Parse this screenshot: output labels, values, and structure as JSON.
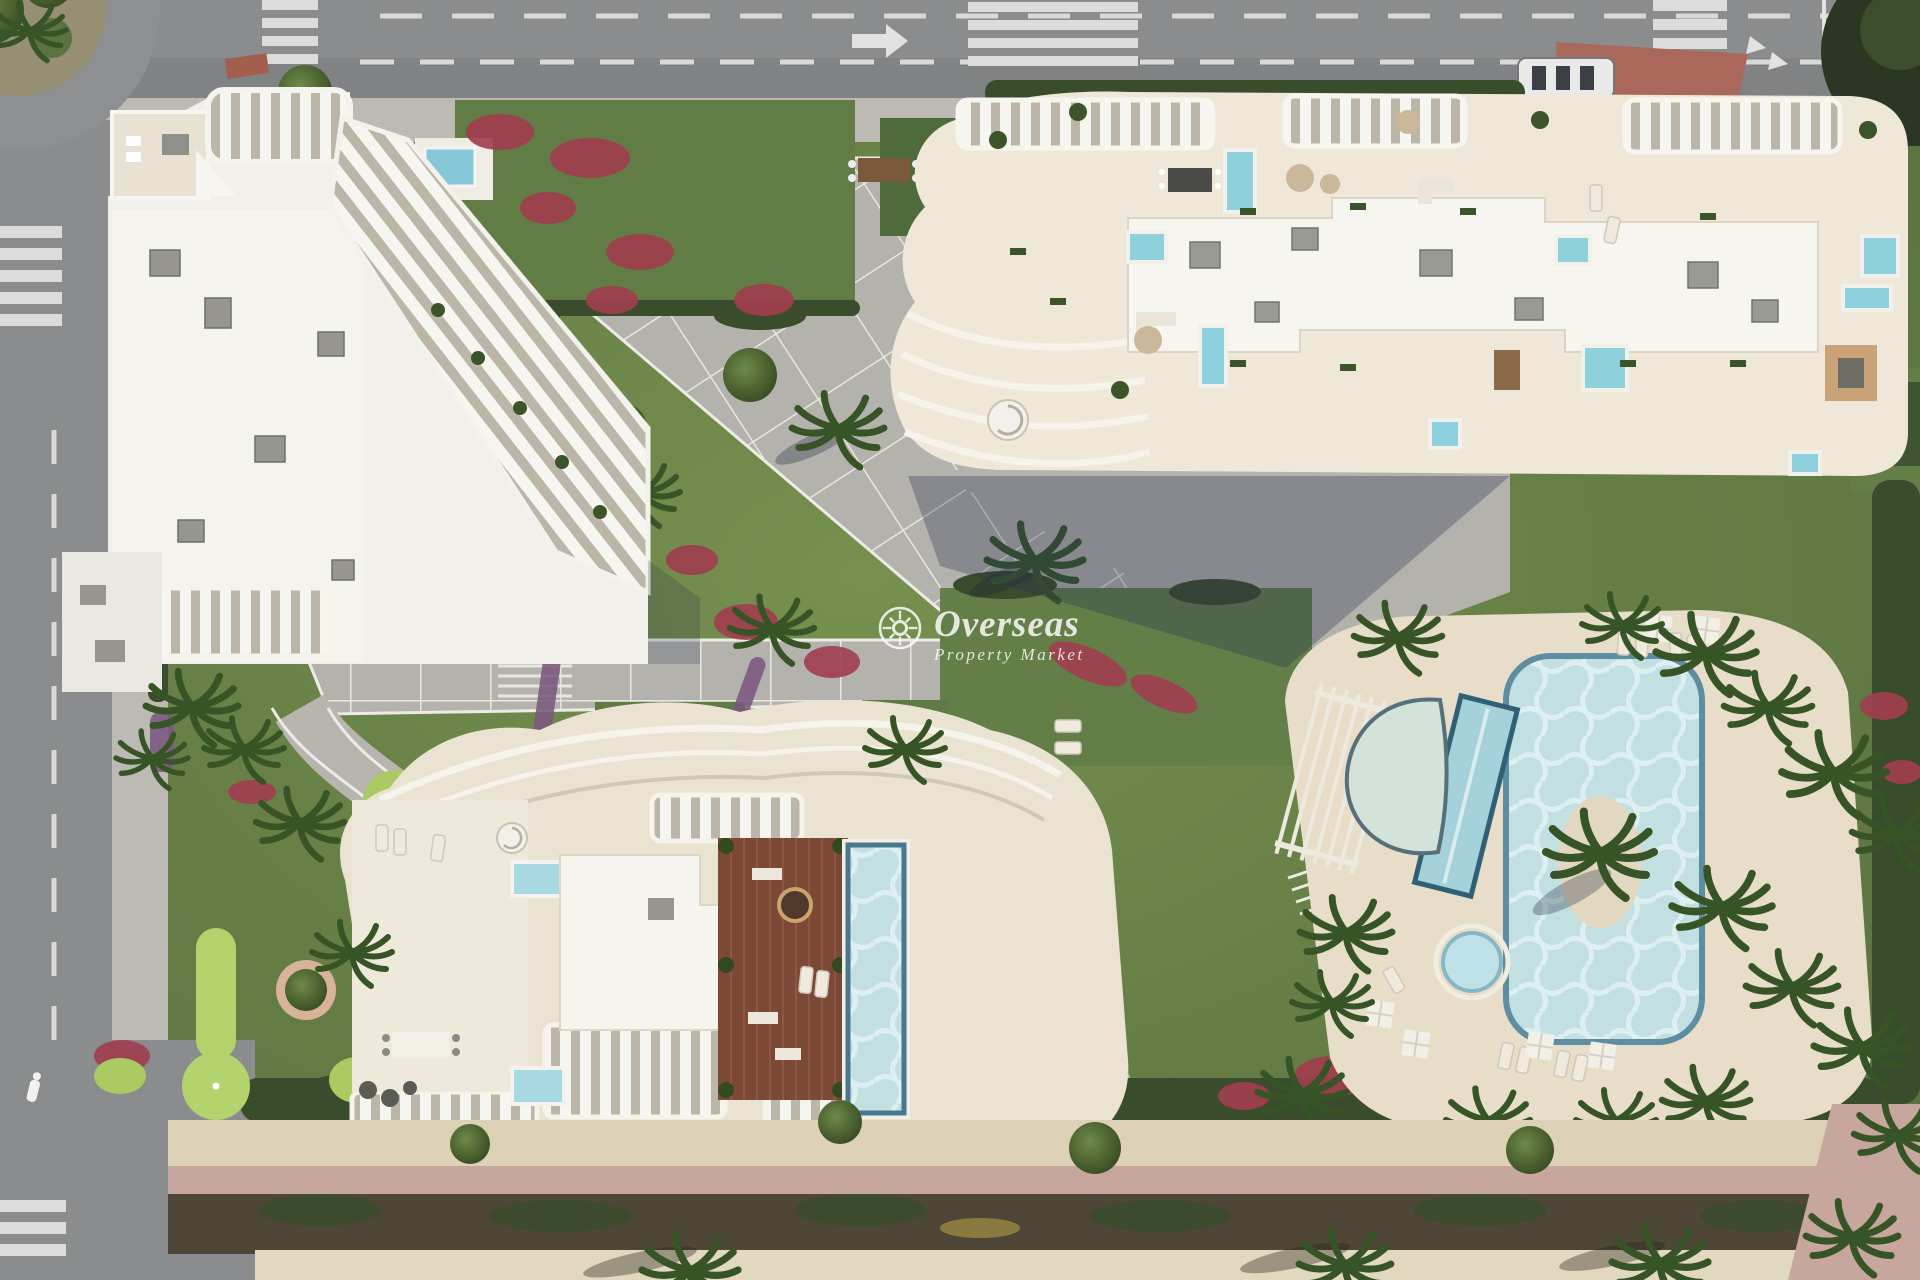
{
  "watermark": {
    "brand": "Overseas",
    "tagline": "Property Market",
    "icon": "sun-icon",
    "color": "#ffffff",
    "opacity": 0.82
  },
  "palette": {
    "road": "#8b8c8e",
    "road_dark": "#7d7f81",
    "road_marking": "#dededc",
    "sidewalk": "#bdbab3",
    "plaza_paving": "#b4b2ad",
    "curb_white": "#ecebe5",
    "building_white": "#f5f3ed",
    "building_cream": "#ece4d4",
    "fin_shadow": "#bcb6a8",
    "lawn": "#6b864c",
    "lawn_dark": "#52693a",
    "minigolf_green": "#a9cb62",
    "hedge": "#394c2b",
    "flower_red": "#a13f4f",
    "flower_purple": "#7b5880",
    "pool_water": "#c2dfe2",
    "pool_rim": "#4e7f96",
    "wood_deck": "#7c4936",
    "sand": "#ddd1b8",
    "promenade_pink": "#c7a69d",
    "soil_shadow": "#4e4636"
  },
  "scene": {
    "view": "aerial top-down 3d architectural render",
    "elements": [
      "roundabout",
      "city-roads",
      "zebra-crossings",
      "apartment-building-northwest",
      "apartment-building-northeast",
      "apartment-building-south",
      "rooftop-terraces",
      "rooftop-plunge-pools",
      "rooftop-wood-deck-pool",
      "central-plaza",
      "palm-trees",
      "flower-beds",
      "communal-pool",
      "lap-pool",
      "splash-pool",
      "kids-pool",
      "pool-island",
      "sun-loungers",
      "parasols",
      "pergola",
      "mini-golf-course",
      "garden-paths",
      "beach-promenade"
    ]
  }
}
